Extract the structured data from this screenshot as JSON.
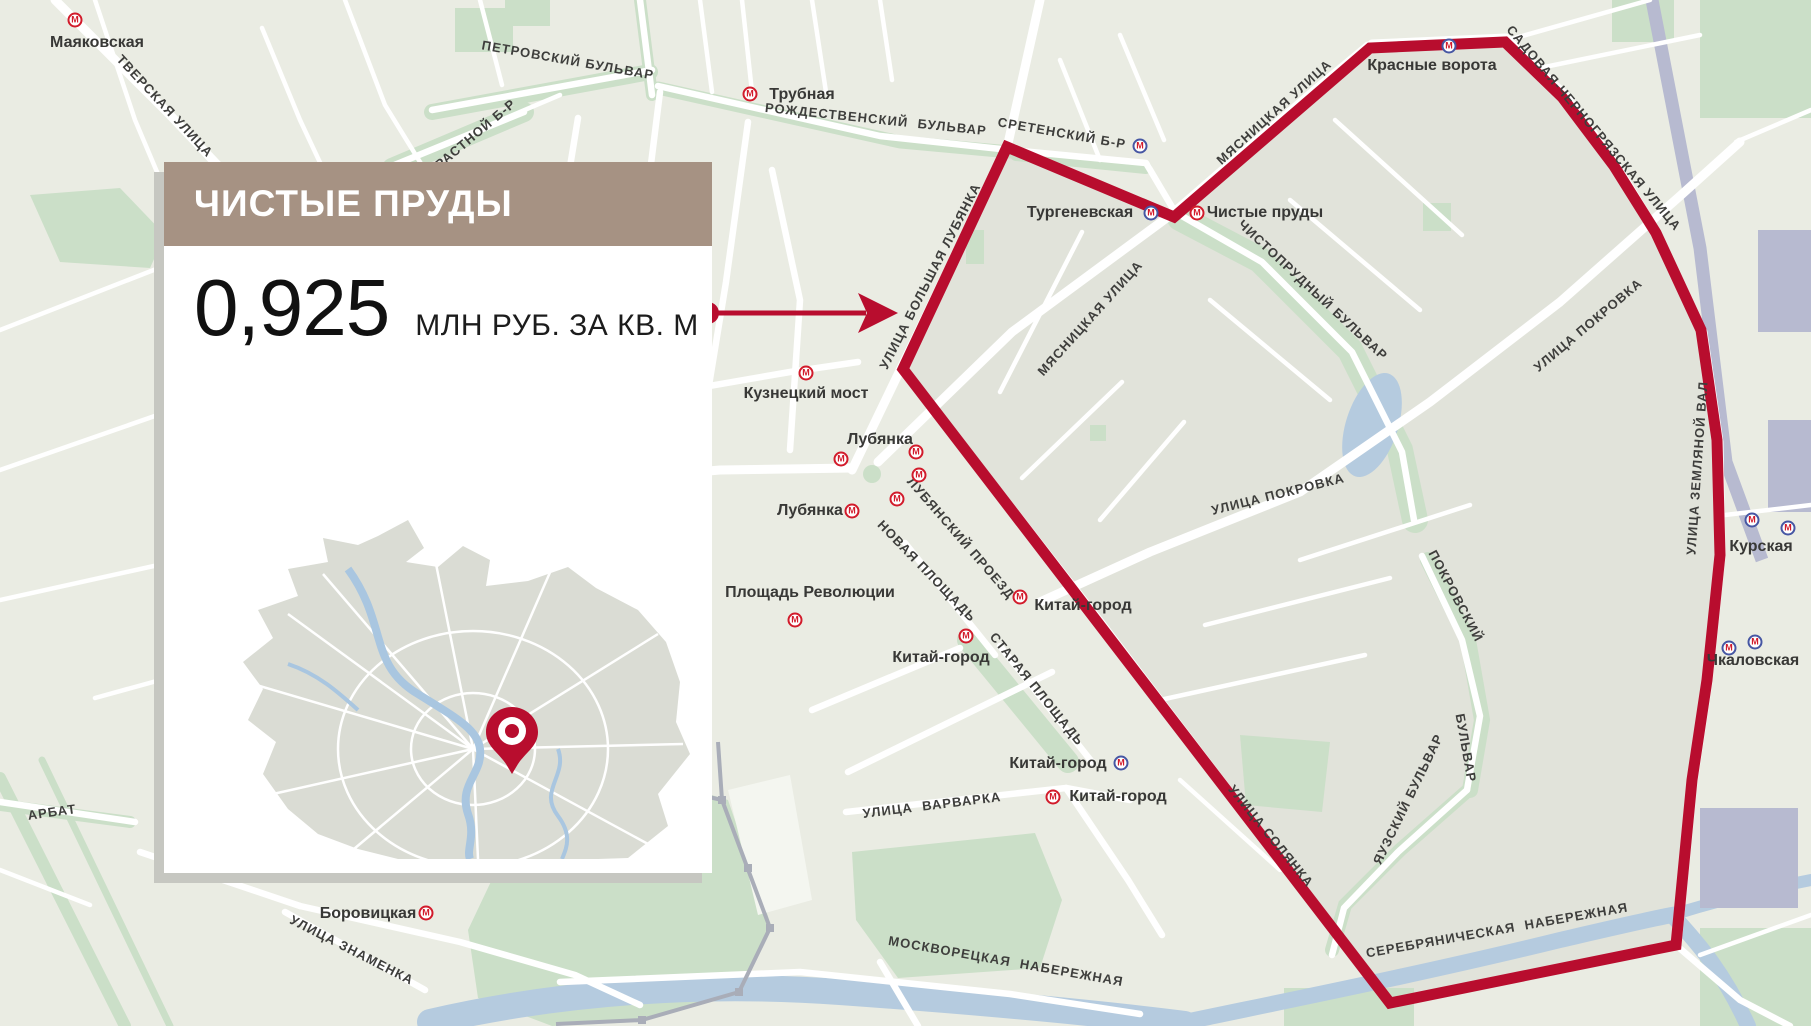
{
  "card": {
    "title": "ЧИСТЫЕ ПРУДЫ",
    "price": "0,925",
    "unit": "МЛН РУБ. ЗА КВ. М"
  },
  "map": {
    "metro_glyph": "М",
    "street_labels": [
      {
        "text": "ТВЕРСКАЯ УЛИЦА",
        "x": 165,
        "y": 106,
        "rot": 47
      },
      {
        "text": "ПЕТРОВСКИЙ БУЛЬВАР",
        "x": 568,
        "y": 60,
        "rot": 10
      },
      {
        "text": "СТРАСТНОЙ Б-Р",
        "x": 468,
        "y": 140,
        "rot": -40
      },
      {
        "text": "РОЖДЕСТВЕНСКИЙ  БУЛЬВАР",
        "x": 876,
        "y": 119,
        "rot": 6
      },
      {
        "text": "СРЕТЕНСКИЙ Б-Р",
        "x": 1062,
        "y": 133,
        "rot": 10
      },
      {
        "text": "МЯСНИЦКАЯ УЛИЦА",
        "x": 1274,
        "y": 112,
        "rot": -42
      },
      {
        "text": "САДОВАЯ-ЧЕРНОГРЯЗСКАЯ УЛИЦА",
        "x": 1594,
        "y": 128,
        "rot": 50
      },
      {
        "text": "УЛИЦА БОЛЬШАЯ ЛУБЯНКА",
        "x": 930,
        "y": 276,
        "rot": -63
      },
      {
        "text": "МЯСНИЦКАЯ УЛИЦА",
        "x": 1090,
        "y": 318,
        "rot": -48
      },
      {
        "text": "ЧИСТОПРУДНЫЙ БУЛЬВАР",
        "x": 1313,
        "y": 290,
        "rot": 43
      },
      {
        "text": "УЛИЦА ПОКРОВКА",
        "x": 1278,
        "y": 494,
        "rot": -14
      },
      {
        "text": "УЛИЦА ПОКРОВКА",
        "x": 1588,
        "y": 325,
        "rot": -40
      },
      {
        "text": "УЛИЦА ЗЕМЛЯНОЙ ВАЛ",
        "x": 1697,
        "y": 468,
        "rot": -86
      },
      {
        "text": "ПОКРОВСКИЙ",
        "x": 1456,
        "y": 596,
        "rot": 62
      },
      {
        "text": "БУЛЬВАР",
        "x": 1466,
        "y": 748,
        "rot": 80
      },
      {
        "text": "ЯУЗСКИЙ БУЛЬВАР",
        "x": 1408,
        "y": 799,
        "rot": -64
      },
      {
        "text": "УЛИЦА СОЛЯНКА",
        "x": 1271,
        "y": 836,
        "rot": 51
      },
      {
        "text": "ЛУБЯНСКИЙ ПРОЕЗД",
        "x": 961,
        "y": 538,
        "rot": 49
      },
      {
        "text": "НОВАЯ ПЛОЩАДЬ",
        "x": 927,
        "y": 571,
        "rot": 46
      },
      {
        "text": "СТАРАЯ ПЛОЩАДЬ",
        "x": 1037,
        "y": 689,
        "rot": 51
      },
      {
        "text": "УЛИЦА  ВАРВАРКА",
        "x": 932,
        "y": 805,
        "rot": -7
      },
      {
        "text": "МОСКВОРЕЦКАЯ  НАБЕРЕЖНАЯ",
        "x": 1006,
        "y": 961,
        "rot": 10
      },
      {
        "text": "СЕРЕБРЯНИЧЕСКАЯ  НАБЕРЕЖНАЯ",
        "x": 1497,
        "y": 930,
        "rot": -10
      },
      {
        "text": "АРБАТ",
        "x": 52,
        "y": 812,
        "rot": -8
      },
      {
        "text": "УЛИЦА ЗНАМЕНКА",
        "x": 352,
        "y": 950,
        "rot": 27
      }
    ],
    "metro_stations": [
      {
        "name": "Маяковская",
        "x": 97,
        "y": 43,
        "icons": [
          {
            "x": 75,
            "y": 20,
            "variant": "red"
          }
        ]
      },
      {
        "name": "Трубная",
        "x": 802,
        "y": 95,
        "icons": [
          {
            "x": 750,
            "y": 94,
            "variant": "red"
          }
        ]
      },
      {
        "name": "Тургеневская",
        "x": 1080,
        "y": 213,
        "icons": [
          {
            "x": 1151,
            "y": 213,
            "variant": "blue"
          }
        ]
      },
      {
        "name": "Чистые пруды",
        "x": 1265,
        "y": 213,
        "icons": [
          {
            "x": 1197,
            "y": 213,
            "variant": "red"
          }
        ]
      },
      {
        "name": "Красные ворота",
        "x": 1432,
        "y": 66,
        "icons": [
          {
            "x": 1449,
            "y": 46,
            "variant": "blue"
          }
        ]
      },
      {
        "name": "Курская",
        "x": 1761,
        "y": 547,
        "icons": [
          {
            "x": 1752,
            "y": 520,
            "variant": "blue"
          },
          {
            "x": 1788,
            "y": 528,
            "variant": "blue"
          }
        ]
      },
      {
        "name": "Чкаловская",
        "x": 1753,
        "y": 661,
        "icons": [
          {
            "x": 1729,
            "y": 648,
            "variant": "blue"
          },
          {
            "x": 1755,
            "y": 642,
            "variant": "blue"
          }
        ]
      },
      {
        "name": "Кузнецкий мост",
        "x": 806,
        "y": 394,
        "icons": [
          {
            "x": 806,
            "y": 373,
            "variant": "red"
          }
        ]
      },
      {
        "name": "Лубянка",
        "x": 880,
        "y": 440,
        "icons": [
          {
            "x": 841,
            "y": 459,
            "variant": "red"
          },
          {
            "x": 916,
            "y": 452,
            "variant": "red"
          },
          {
            "x": 919,
            "y": 475,
            "variant": "red"
          },
          {
            "x": 897,
            "y": 499,
            "variant": "red"
          }
        ]
      },
      {
        "name": "Лубянка",
        "x": 810,
        "y": 511,
        "icons": [
          {
            "x": 852,
            "y": 511,
            "variant": "red"
          }
        ]
      },
      {
        "name": "Площадь Революции",
        "x": 810,
        "y": 593,
        "icons": [
          {
            "x": 795,
            "y": 620,
            "variant": "red"
          }
        ]
      },
      {
        "name": "Китай-город",
        "x": 941,
        "y": 658,
        "icons": [
          {
            "x": 966,
            "y": 636,
            "variant": "red"
          }
        ]
      },
      {
        "name": "Китай-город",
        "x": 1083,
        "y": 606,
        "icons": [
          {
            "x": 1020,
            "y": 597,
            "variant": "red"
          }
        ]
      },
      {
        "name": "Китай-город",
        "x": 1058,
        "y": 764,
        "icons": [
          {
            "x": 1121,
            "y": 763,
            "variant": "blue"
          }
        ]
      },
      {
        "name": "Китай-город",
        "x": 1118,
        "y": 797,
        "icons": [
          {
            "x": 1053,
            "y": 797,
            "variant": "red"
          }
        ]
      },
      {
        "name": "Боровицкая",
        "x": 368,
        "y": 914,
        "icons": [
          {
            "x": 426,
            "y": 913,
            "variant": "red"
          }
        ]
      }
    ],
    "standalone_icons": [
      {
        "x": 1140,
        "y": 146,
        "variant": "blue"
      }
    ]
  },
  "colors": {
    "accent_red": "#b80d2e",
    "metro_red": "#d21b2b",
    "metro_blue": "#4656a3",
    "header_taupe": "#a69283",
    "map_bg": "#eaece3",
    "block_inner": "#e1e3da",
    "park_green": "#cbdfc8",
    "water_blue": "#b5cbdf",
    "rail_lavender": "#b7bad0",
    "label_dark": "#3e3e3c",
    "station_dark": "#383836",
    "shadow_gray": "#c6c7c1"
  }
}
